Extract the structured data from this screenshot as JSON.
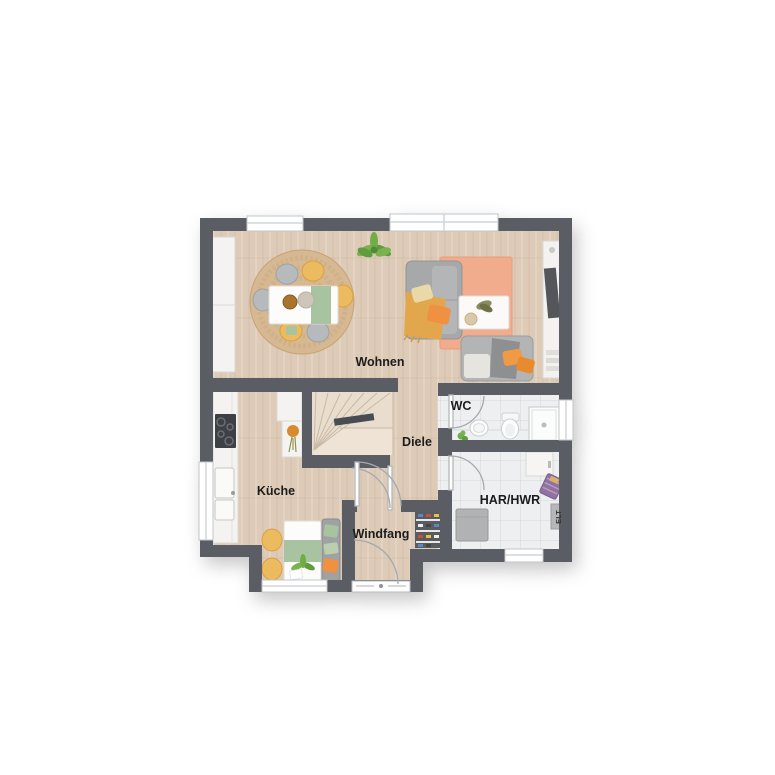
{
  "floorplan": {
    "type": "ground-floor-plan",
    "rooms": {
      "wohnen": {
        "label": "Wohnen"
      },
      "kueche": {
        "label": "Küche"
      },
      "diele": {
        "label": "Diele"
      },
      "windfang": {
        "label": "Windfang"
      },
      "wc": {
        "label": "WC"
      },
      "har_hwr": {
        "label": "HAR/HWR"
      },
      "elt": {
        "label": "ELT"
      }
    },
    "palette": {
      "wall": "#5a5d63",
      "wood_floor": "#ddcbb8",
      "wood_floor_light": "#e7d8c7",
      "tile_floor": "#edeff0",
      "cabinet_white": "#f4f3f1",
      "sofa_gray": "#a7a8aa",
      "rug_salmon": "#f0ac8c",
      "rug_jute": "#d6b992",
      "accent_yellow": "#ecba5e",
      "accent_orange": "#ef9140",
      "accent_green": "#a8c3a0",
      "plant_green": "#7cb14f",
      "background": "#ffffff"
    }
  }
}
